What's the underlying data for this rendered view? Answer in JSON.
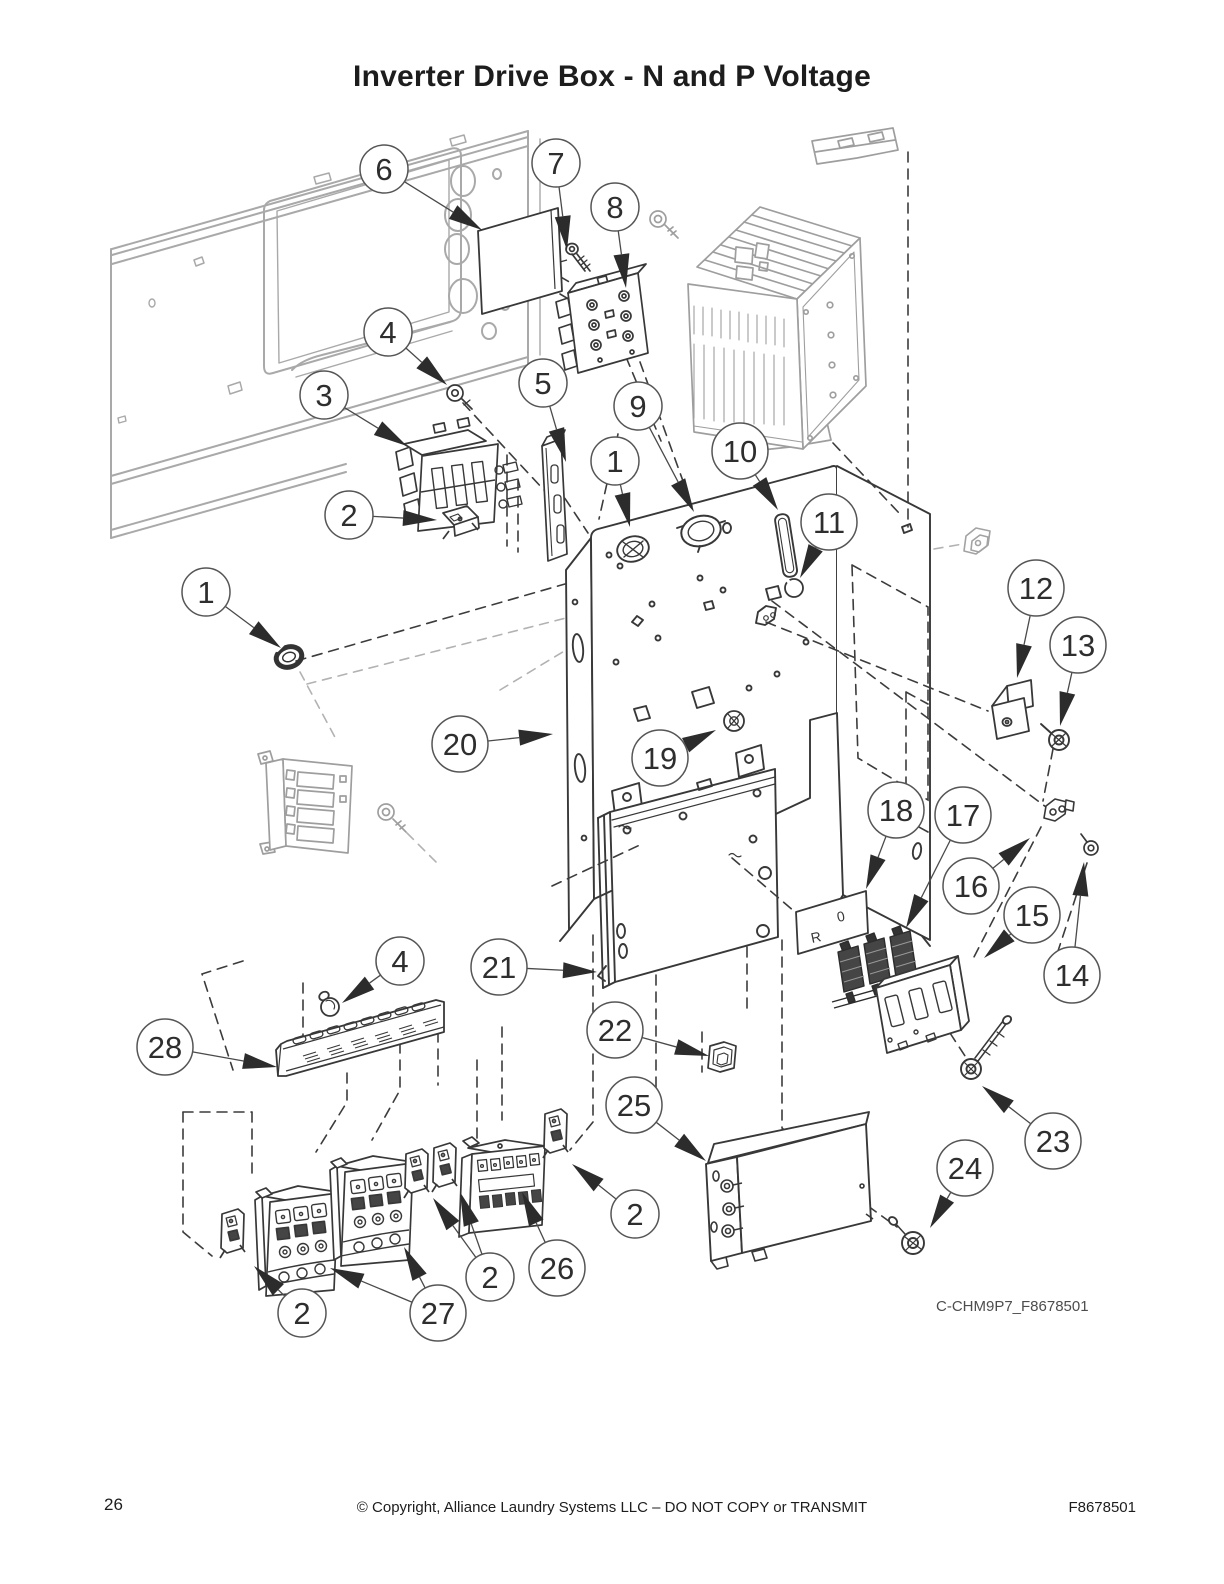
{
  "page": {
    "title": "Inverter Drive Box - N and P Voltage",
    "footer": {
      "page_number": "26",
      "copyright": "© Copyright, Alliance Laundry Systems LLC – DO NOT COPY or TRANSMIT",
      "doc_number": "F8678501"
    }
  },
  "diagram": {
    "code": "C-CHM9P7_F8678501",
    "plate_markings": [
      "R",
      "0"
    ],
    "callouts": [
      {
        "n": "6",
        "x": 384,
        "y": 169,
        "arrows": [
          [
            482,
            230
          ]
        ]
      },
      {
        "n": "7",
        "x": 556,
        "y": 163,
        "arrows": [
          [
            567,
            250
          ]
        ]
      },
      {
        "n": "8",
        "x": 615,
        "y": 207,
        "arrows": [
          [
            626,
            288
          ]
        ]
      },
      {
        "n": "4",
        "x": 388,
        "y": 332,
        "arrows": [
          [
            447,
            385
          ]
        ]
      },
      {
        "n": "3",
        "x": 324,
        "y": 395,
        "arrows": [
          [
            407,
            446
          ]
        ]
      },
      {
        "n": "5",
        "x": 543,
        "y": 383,
        "arrows": [
          [
            566,
            462
          ]
        ]
      },
      {
        "n": "9",
        "x": 638,
        "y": 406,
        "arrows": [
          [
            694,
            512
          ]
        ]
      },
      {
        "n": "1",
        "x": 615,
        "y": 461,
        "arrows": [
          [
            630,
            527
          ]
        ]
      },
      {
        "n": "10",
        "x": 740,
        "y": 451,
        "arrows": [
          [
            778,
            510
          ]
        ]
      },
      {
        "n": "11",
        "x": 829,
        "y": 522,
        "arrows": [
          [
            800,
            578
          ]
        ]
      },
      {
        "n": "2",
        "x": 349,
        "y": 515,
        "arrows": [
          [
            437,
            520
          ]
        ]
      },
      {
        "n": "1",
        "x": 206,
        "y": 592,
        "arrows": [
          [
            281,
            648
          ]
        ]
      },
      {
        "n": "12",
        "x": 1036,
        "y": 588,
        "arrows": [
          [
            1017,
            678
          ]
        ]
      },
      {
        "n": "13",
        "x": 1078,
        "y": 645,
        "arrows": [
          [
            1060,
            726
          ]
        ]
      },
      {
        "n": "20",
        "x": 460,
        "y": 744,
        "arrows": [
          [
            553,
            734
          ]
        ]
      },
      {
        "n": "19",
        "x": 660,
        "y": 758,
        "arrows": [
          [
            716,
            730
          ]
        ]
      },
      {
        "n": "18",
        "x": 896,
        "y": 810,
        "arrows": [
          [
            866,
            889
          ]
        ]
      },
      {
        "n": "17",
        "x": 963,
        "y": 815,
        "arrows": [
          [
            906,
            928
          ]
        ]
      },
      {
        "n": "16",
        "x": 971,
        "y": 886,
        "arrows": [
          [
            1030,
            838
          ]
        ]
      },
      {
        "n": "15",
        "x": 1032,
        "y": 915,
        "arrows": [
          [
            984,
            958
          ]
        ]
      },
      {
        "n": "14",
        "x": 1072,
        "y": 975,
        "arrows": [
          [
            1084,
            862
          ]
        ]
      },
      {
        "n": "4",
        "x": 400,
        "y": 961,
        "arrows": [
          [
            342,
            1003
          ]
        ]
      },
      {
        "n": "21",
        "x": 499,
        "y": 967,
        "arrows": [
          [
            597,
            972
          ]
        ]
      },
      {
        "n": "22",
        "x": 615,
        "y": 1030,
        "arrows": [
          [
            709,
            1056
          ]
        ]
      },
      {
        "n": "28",
        "x": 165,
        "y": 1047,
        "arrows": [
          [
            277,
            1067
          ]
        ]
      },
      {
        "n": "25",
        "x": 634,
        "y": 1105,
        "arrows": [
          [
            706,
            1161
          ]
        ]
      },
      {
        "n": "2",
        "x": 635,
        "y": 1214,
        "arrows": [
          [
            572,
            1164
          ]
        ]
      },
      {
        "n": "26",
        "x": 557,
        "y": 1268,
        "arrows": [
          [
            522,
            1192
          ]
        ]
      },
      {
        "n": "2",
        "x": 490,
        "y": 1277,
        "arrows": [
          [
            433,
            1198
          ],
          [
            460,
            1192
          ]
        ]
      },
      {
        "n": "27",
        "x": 438,
        "y": 1313,
        "arrows": [
          [
            330,
            1268
          ],
          [
            404,
            1247
          ]
        ]
      },
      {
        "n": "2",
        "x": 302,
        "y": 1313,
        "arrows": [
          [
            254,
            1266
          ]
        ]
      },
      {
        "n": "23",
        "x": 1053,
        "y": 1141,
        "arrows": [
          [
            982,
            1086
          ]
        ]
      },
      {
        "n": "24",
        "x": 965,
        "y": 1168,
        "arrows": [
          [
            930,
            1228
          ]
        ]
      }
    ]
  }
}
